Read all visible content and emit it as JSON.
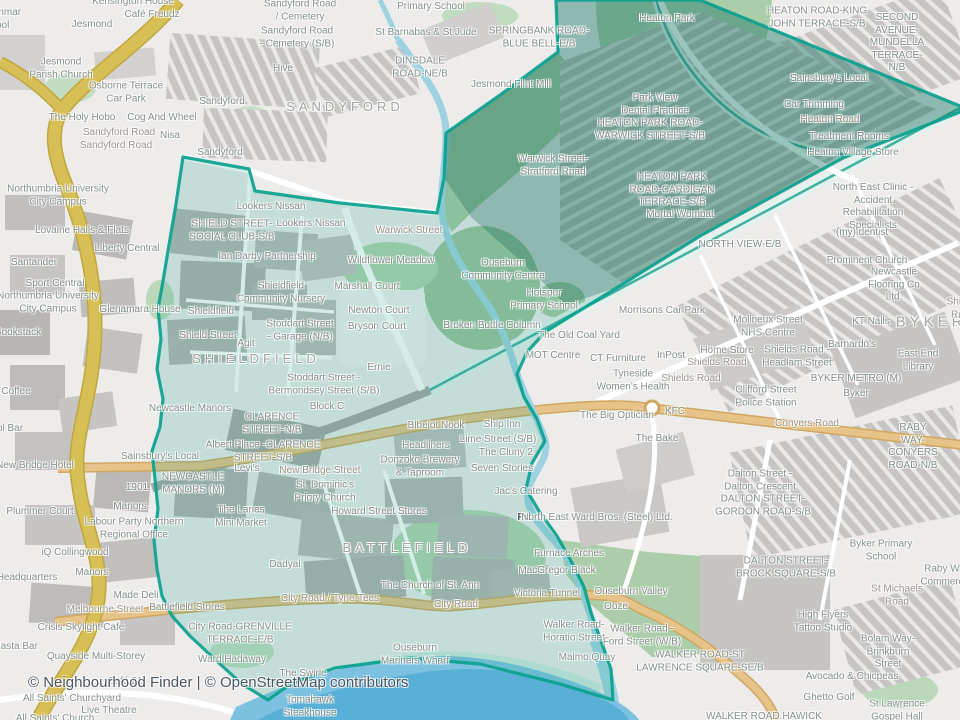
{
  "attribution": {
    "text": "© Neighbourhood Finder | © OpenStreetMap contributors"
  },
  "map": {
    "highlight_color": "#0aa18e",
    "water_color": "#7cc2e0",
    "motorway_color": "#d6bf55",
    "primary_road_color": "#e6c389",
    "labels": [
      {
        "t": "Kensington House",
        "x": 133,
        "y": 2
      },
      {
        "t": "Café Freudz",
        "x": 152,
        "y": 15
      },
      {
        "t": "Jesmond",
        "x": 92,
        "y": 25
      },
      {
        "t": "Grammar",
        "x": 0,
        "y": 13
      },
      {
        "t": "School",
        "x": -6,
        "y": 26
      },
      {
        "t": "Primary School",
        "x": 431,
        "y": 7
      },
      {
        "t": "Sandyford Road\n/ Cemetery",
        "x": 300,
        "y": 11
      },
      {
        "t": "Sandyford Road\n- Cemetery (S/B)",
        "x": 297,
        "y": 38
      },
      {
        "t": "St Barnabas & St Jude",
        "x": 426,
        "y": 33
      },
      {
        "t": "SPRINGBANK ROAD-\nBLUE BELL-E/B",
        "x": 539,
        "y": 38
      },
      {
        "t": "DINSDALE\nROAD-NE/B",
        "x": 420,
        "y": 68
      },
      {
        "t": "Heaton Park",
        "x": 667,
        "y": 19
      },
      {
        "t": "HEATON ROAD-KING\nJOHN TERRACE-S/B",
        "x": 817,
        "y": 18
      },
      {
        "t": "SECOND AVENUE-\nMUNDELLA TERRACE-N/B",
        "x": 897,
        "y": 43
      },
      {
        "t": "Jesmond\nParish Church",
        "x": 61,
        "y": 69
      },
      {
        "t": "Osborne Terrace\nCar Park",
        "x": 126,
        "y": 93
      },
      {
        "t": "Hive",
        "x": 283,
        "y": 69
      },
      {
        "t": "Sandyford",
        "x": 222,
        "y": 102
      },
      {
        "t": "SANDYFORD",
        "x": 345,
        "y": 107,
        "s": 13,
        "c": "d"
      },
      {
        "t": "Jesmond Flint Mill",
        "x": 511,
        "y": 85
      },
      {
        "t": "Sainsbury's Local",
        "x": 829,
        "y": 79
      },
      {
        "t": "The Holy Hobo",
        "x": 82,
        "y": 118
      },
      {
        "t": "Cog And Wheel",
        "x": 162,
        "y": 118
      },
      {
        "t": "Sandyford Road",
        "x": 119,
        "y": 133,
        "c": "r"
      },
      {
        "t": "Sandyford Road",
        "x": 116,
        "y": 146,
        "c": "r"
      },
      {
        "t": "Nisa",
        "x": 170,
        "y": 136
      },
      {
        "t": "Sandyford",
        "x": 220,
        "y": 153
      },
      {
        "t": "Car Trimming",
        "x": 814,
        "y": 105
      },
      {
        "t": "Heaton Road",
        "x": 830,
        "y": 120,
        "c": "r"
      },
      {
        "t": "Treatment Rooms",
        "x": 849,
        "y": 137
      },
      {
        "t": "Heaton Village Store",
        "x": 853,
        "y": 153
      },
      {
        "t": "Park View\nDental Practice",
        "x": 655,
        "y": 105
      },
      {
        "t": "HEATON PARK ROAD-\nWARWICK STREET-S/B",
        "x": 650,
        "y": 130
      },
      {
        "t": "Warwick Street-\nStratford Road",
        "x": 553,
        "y": 166
      },
      {
        "t": "HEATON PARK\nROAD-CARDIGAN\nTERRACE-S/B",
        "x": 672,
        "y": 190
      },
      {
        "t": "Mortal Wombat",
        "x": 680,
        "y": 215
      },
      {
        "t": "North East Clinic -\nAccident Rehabilitation\nSpecialists",
        "x": 873,
        "y": 207
      },
      {
        "t": "(my) dentist",
        "x": 862,
        "y": 233
      },
      {
        "t": "NORTH VIEW-E/B",
        "x": 740,
        "y": 245
      },
      {
        "t": "Prominent Church",
        "x": 867,
        "y": 261
      },
      {
        "t": "Newcastle\nFlooring Co Ltd.",
        "x": 894,
        "y": 285
      },
      {
        "t": "Northumbria University\nCity Campus",
        "x": 58,
        "y": 196
      },
      {
        "t": "Lovaine Halls & Flats",
        "x": 82,
        "y": 231
      },
      {
        "t": "Liberty Central",
        "x": 127,
        "y": 249
      },
      {
        "t": "Santander",
        "x": 34,
        "y": 263
      },
      {
        "t": "Sport Central",
        "x": 55,
        "y": 284
      },
      {
        "t": "Northumbria University\nCity Campus",
        "x": 48,
        "y": 303
      },
      {
        "t": "Glenamara House",
        "x": 140,
        "y": 310
      },
      {
        "t": "Bookstack",
        "x": 18,
        "y": 333
      },
      {
        "t": "Coffee",
        "x": 16,
        "y": 392
      },
      {
        "t": "Lookers Nissan",
        "x": 271,
        "y": 207
      },
      {
        "t": "Lookers Nissan",
        "x": 311,
        "y": 224
      },
      {
        "t": "SHIELD STREET-\nSOCIAL CLUB-S/B",
        "x": 232,
        "y": 231
      },
      {
        "t": "Warwick Street",
        "x": 409,
        "y": 231,
        "c": "r"
      },
      {
        "t": "Ian Darby Partnership",
        "x": 267,
        "y": 257
      },
      {
        "t": "Wildflower Meadow",
        "x": 391,
        "y": 261
      },
      {
        "t": "Ouseburn\nCommunity Centre",
        "x": 503,
        "y": 270
      },
      {
        "t": "Shieldfield\nCommunity Nursery",
        "x": 281,
        "y": 293
      },
      {
        "t": "Marshall Court",
        "x": 367,
        "y": 287
      },
      {
        "t": "Hotspur\nPrimary School",
        "x": 544,
        "y": 300
      },
      {
        "t": "Newton Court",
        "x": 379,
        "y": 311
      },
      {
        "t": "Shieldfield",
        "x": 211,
        "y": 312
      },
      {
        "t": "Bryson Court",
        "x": 377,
        "y": 327
      },
      {
        "t": "Stoddart Street\n- Garage (N/B)",
        "x": 300,
        "y": 331
      },
      {
        "t": "Shield Street",
        "x": 208,
        "y": 336
      },
      {
        "t": "Agit",
        "x": 246,
        "y": 344
      },
      {
        "t": "SHIELDFIELD",
        "x": 256,
        "y": 359,
        "s": 13,
        "c": "d"
      },
      {
        "t": "Ernie",
        "x": 379,
        "y": 368
      },
      {
        "t": "Broken Bottle Column",
        "x": 492,
        "y": 326
      },
      {
        "t": "Morrisons Car Park",
        "x": 662,
        "y": 311
      },
      {
        "t": "The Old Coal Yard",
        "x": 579,
        "y": 336
      },
      {
        "t": "MOT Centre",
        "x": 553,
        "y": 356
      },
      {
        "t": "CT Furniture",
        "x": 618,
        "y": 359
      },
      {
        "t": "InPost",
        "x": 671,
        "y": 356
      },
      {
        "t": "Home Store",
        "x": 727,
        "y": 351
      },
      {
        "t": "Shields Road",
        "x": 717,
        "y": 363,
        "c": "r"
      },
      {
        "t": "Shields Road",
        "x": 691,
        "y": 379,
        "c": "r"
      },
      {
        "t": "Shields Road -\nHeadlam Street",
        "x": 797,
        "y": 357
      },
      {
        "t": "Molineux Street\nNHS Centre",
        "x": 768,
        "y": 327
      },
      {
        "t": "KT Nails",
        "x": 871,
        "y": 322
      },
      {
        "t": "BYKER",
        "x": 931,
        "y": 323,
        "s": 15,
        "c": "d"
      },
      {
        "t": "Barnardo's",
        "x": 852,
        "y": 345
      },
      {
        "t": "East End Library",
        "x": 918,
        "y": 361
      },
      {
        "t": "BYKER METRO (M)",
        "x": 856,
        "y": 379
      },
      {
        "t": "Byker",
        "x": 856,
        "y": 394
      },
      {
        "t": "Clifford Street\nPolice Station",
        "x": 766,
        "y": 397
      },
      {
        "t": "Conyers Road",
        "x": 807,
        "y": 424,
        "c": "r"
      },
      {
        "t": "RABY WAY-CONYERS\nROAD-N/B",
        "x": 913,
        "y": 447
      },
      {
        "t": "Tyneside\nWomen's Health",
        "x": 633,
        "y": 381
      },
      {
        "t": "The Big Optician",
        "x": 617,
        "y": 416
      },
      {
        "t": "KFC",
        "x": 675,
        "y": 412
      },
      {
        "t": "The Bake",
        "x": 657,
        "y": 439
      },
      {
        "t": "Shields Road",
        "x": 963,
        "y": 309,
        "c": "r"
      },
      {
        "t": "Stoddart Street -\nBermondsey Street (S/B)",
        "x": 324,
        "y": 385
      },
      {
        "t": "Block C",
        "x": 327,
        "y": 407
      },
      {
        "t": "Newcastle Manors",
        "x": 190,
        "y": 409
      },
      {
        "t": "CLARENCE\nSTREET-N/B",
        "x": 272,
        "y": 424
      },
      {
        "t": "Albert Place -CLARENCE\nSTREET-S/B",
        "x": 263,
        "y": 452
      },
      {
        "t": "Levi's",
        "x": 247,
        "y": 469
      },
      {
        "t": "New Bridge Street",
        "x": 320,
        "y": 471,
        "c": "r"
      },
      {
        "t": "Sainsbury's Local",
        "x": 160,
        "y": 457
      },
      {
        "t": "1901",
        "x": 137,
        "y": 488
      },
      {
        "t": "NEWCASTLE\nMANORS (M)",
        "x": 193,
        "y": 484
      },
      {
        "t": "St. Dominic's\nPriory Church",
        "x": 325,
        "y": 492
      },
      {
        "t": "The Lanes\nMini Market",
        "x": 241,
        "y": 517
      },
      {
        "t": "Howard Street Stores",
        "x": 379,
        "y": 512
      },
      {
        "t": "Bibelot Nook",
        "x": 436,
        "y": 426
      },
      {
        "t": "Headliners",
        "x": 426,
        "y": 446
      },
      {
        "t": "Donzoko Brewery\n& Taproom",
        "x": 420,
        "y": 467
      },
      {
        "t": "Ship Inn",
        "x": 502,
        "y": 425
      },
      {
        "t": "Lime Street (S/B)",
        "x": 498,
        "y": 440
      },
      {
        "t": "The Cluny 2",
        "x": 506,
        "y": 453
      },
      {
        "t": "Seven Stories",
        "x": 502,
        "y": 469
      },
      {
        "t": "Jac's Catering",
        "x": 526,
        "y": 492
      },
      {
        "t": "Pri",
        "x": 524,
        "y": 518,
        "c": "b"
      },
      {
        "t": "North East Ward Bros. (Steel) Ltd.",
        "x": 597,
        "y": 518
      },
      {
        "t": "Manors",
        "x": 130,
        "y": 507
      },
      {
        "t": "Labour Party Northern\nRegional Office",
        "x": 134,
        "y": 529
      },
      {
        "t": "Plummer Court",
        "x": 40,
        "y": 512
      },
      {
        "t": "iQ Collingwood",
        "x": 75,
        "y": 553
      },
      {
        "t": "Manors",
        "x": 92,
        "y": 573
      },
      {
        "t": "Headquarters",
        "x": 27,
        "y": 578
      },
      {
        "t": "Made Deli",
        "x": 136,
        "y": 596
      },
      {
        "t": "Melbourne Street",
        "x": 105,
        "y": 610,
        "c": "r"
      },
      {
        "t": "New Bridge Hotel",
        "x": 35,
        "y": 466
      },
      {
        "t": "ol Bar",
        "x": 10,
        "y": 429
      },
      {
        "t": "Dadyal",
        "x": 285,
        "y": 565
      },
      {
        "t": "BATTLEFIELD",
        "x": 407,
        "y": 548,
        "s": 13,
        "c": "d"
      },
      {
        "t": "Battlefield Stores",
        "x": 187,
        "y": 608
      },
      {
        "t": "City Road-GRENVILLE\nTERRACE-E/B",
        "x": 240,
        "y": 634
      },
      {
        "t": "City Road / Tyne-Tees",
        "x": 330,
        "y": 599,
        "c": "r"
      },
      {
        "t": "City Road",
        "x": 456,
        "y": 605,
        "c": "r"
      },
      {
        "t": "The Church of St. Ann",
        "x": 430,
        "y": 586
      },
      {
        "t": "Victoria Tunnel",
        "x": 547,
        "y": 594
      },
      {
        "t": "Furnace Arches",
        "x": 569,
        "y": 554
      },
      {
        "t": "MacGregor Black",
        "x": 557,
        "y": 571
      },
      {
        "t": "Ouseburn Valley",
        "x": 631,
        "y": 592
      },
      {
        "t": "Ooze",
        "x": 616,
        "y": 607
      },
      {
        "t": "Walker Road-\nHoratio Street",
        "x": 574,
        "y": 632
      },
      {
        "t": "Walker Road -\nFord Street (W/B)",
        "x": 642,
        "y": 636
      },
      {
        "t": "Malmo Quay",
        "x": 587,
        "y": 658
      },
      {
        "t": "Ouseburn\nMariners Wharf",
        "x": 415,
        "y": 655
      },
      {
        "t": "The Swirle",
        "x": 303,
        "y": 674
      },
      {
        "t": "Ward Hadaway",
        "x": 232,
        "y": 660
      },
      {
        "t": "Café 21",
        "x": 125,
        "y": 682
      },
      {
        "t": "Crisis Skylight Café",
        "x": 81,
        "y": 628
      },
      {
        "t": "Quayside Multi-Storey",
        "x": 96,
        "y": 657
      },
      {
        "t": "Pasta Bar",
        "x": 16,
        "y": 647
      },
      {
        "t": "All Saints' Churchyard",
        "x": 72,
        "y": 699
      },
      {
        "t": "Live Theatre",
        "x": 109,
        "y": 711
      },
      {
        "t": "All Saints' Church",
        "x": 55,
        "y": 719
      },
      {
        "t": "Tomahawk\nSteakhouse",
        "x": 310,
        "y": 707
      },
      {
        "t": "WALKER ROAD-ST\nLAWRENCE SQUARE-SE/B",
        "x": 700,
        "y": 662
      },
      {
        "t": "WALKER ROAD HAWICK",
        "x": 764,
        "y": 717
      },
      {
        "t": "DALTON STREET-\nBROCK SQUARE-S/B",
        "x": 786,
        "y": 568
      },
      {
        "t": "Byker Primary School",
        "x": 881,
        "y": 551
      },
      {
        "t": "Dalton Street -\nDalton Crescent",
        "x": 760,
        "y": 481
      },
      {
        "t": "DALTON STREET-\nGORDON ROAD-S/B",
        "x": 763,
        "y": 506
      },
      {
        "t": "Raby Way\nCommercial",
        "x": 947,
        "y": 576
      },
      {
        "t": "St Michaels Road",
        "x": 897,
        "y": 596,
        "c": "r"
      },
      {
        "t": "High Flyers\nTattoo Studio",
        "x": 823,
        "y": 622
      },
      {
        "t": "Bolam Way-\nBrinkburn Street",
        "x": 888,
        "y": 652
      },
      {
        "t": "Avocado & Chicpeas",
        "x": 852,
        "y": 677
      },
      {
        "t": "Ghetto Golf",
        "x": 829,
        "y": 698
      },
      {
        "t": "St Lawrence\nGospel Hall",
        "x": 897,
        "y": 711
      }
    ]
  }
}
